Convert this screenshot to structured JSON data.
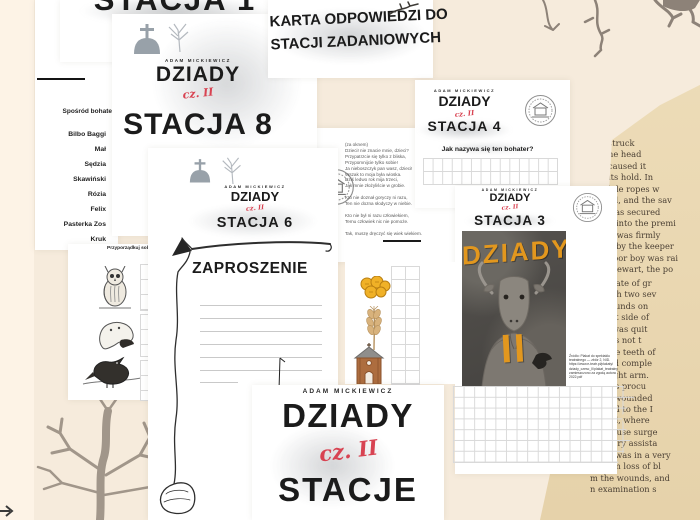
{
  "accent_colors": {
    "red_script": "#d84352",
    "poster_orange": "#e2971e"
  },
  "cover": {
    "author": "ADAM MICKIEWICZ",
    "work": "DZIADY",
    "part": "cz. II",
    "title": "STACJE"
  },
  "station1": {
    "title": "STACJA 1"
  },
  "answer_card": {
    "line1": "KARTA ODPOWIEDZI DO",
    "line2": "STACJI ZADANIOWYCH"
  },
  "station8": {
    "author": "ADAM MICKIEWICZ",
    "work": "DZIADY",
    "part": "cz. II",
    "title": "STACJA 8"
  },
  "station6": {
    "author": "ADAM MICKIEWICZ",
    "work": "DZIADY",
    "part": "cz. II",
    "title": "STACJA 6",
    "invitation_heading": "ZAPROSZENIE"
  },
  "station4": {
    "author": "ADAM MICKIEWICZ",
    "work": "DZIADY",
    "part": "cz. II",
    "title": "STACJA 4",
    "question": "Jak nazywa się ten bohater?"
  },
  "station3": {
    "author": "ADAM MICKIEWICZ",
    "work": "DZIADY",
    "part": "cz. II",
    "title": "STACJA 3",
    "poster_title": "DZIADY",
    "poster_numeral": "II",
    "credit_lines": [
      "Źródło: Plakat do spektaklu",
      "teatralnego — zbiór 2, NID.",
      "https://www.e-teatr.pl/plakaty/",
      "dziady_czesc_II/plakat_teatralny",
      "zamieszczono za zgodą autora",
      "2022.pdf"
    ]
  },
  "character_list": {
    "heading": "Spośród bohate",
    "items": [
      "Bilbo Baggi",
      "Mał",
      "Sędzia",
      "Skawiński",
      "Rózia",
      "Felix",
      "Pasterka Zos",
      "Kruk"
    ]
  },
  "matching_exercise": {
    "heading_line1": "Przyporządkuj sobie zag",
    "heading_line2": "Za"
  },
  "poem_excerpt": {
    "lines": [
      "(za oknem)",
      "Dzieci! nie znacie mnie, dzieci?",
      "Przypatrzcie się tylko z bliska,",
      "Przypomnijcie tylko sobie!",
      "Ja nieboszczyk pan wasz, dzieci!",
      "Wszak to moja była wioska.",
      "Dziś ledwo rok mija trzeci,",
      "Jak mnie złożyliście w grobie.",
      "",
      "Kto nie doznał goryczy ni razu,",
      "Ten nie dozna słodyczy w niebie.",
      "",
      "Kto nie był ni razu człowiekiem,",
      "Temu człowiek nic nie pomoże.",
      "",
      "Tak, muszę dręczyć się wiek wiekiem."
    ]
  },
  "book_clipping": {
    "drop_word": "liv",
    "top_lines": [
      "struck",
      "ne head",
      "caused it",
      "its hold. In",
      "hile ropes w",
      "ed, and the sav",
      "was secured",
      "d into the premi",
      "it was firmly",
      "p by the keeper",
      "poor boy was rai",
      "Stewart, the po"
    ],
    "bottom_lines": [
      "in a state of gr",
      "ng with two sev",
      "ed wounds on",
      "d right side of",
      "nd it was quit",
      "he was not t",
      "es. The teeth of",
      "passed comple",
      "the right arm.",
      "ab was procu",
      "h the wounded",
      "nveyed to the I",
      "ospital, where",
      "the house surge",
      "ed every assista",
      "e boy was in a very",
      "te from loss of bl",
      "m the wounds, and",
      "n examination s"
    ]
  }
}
